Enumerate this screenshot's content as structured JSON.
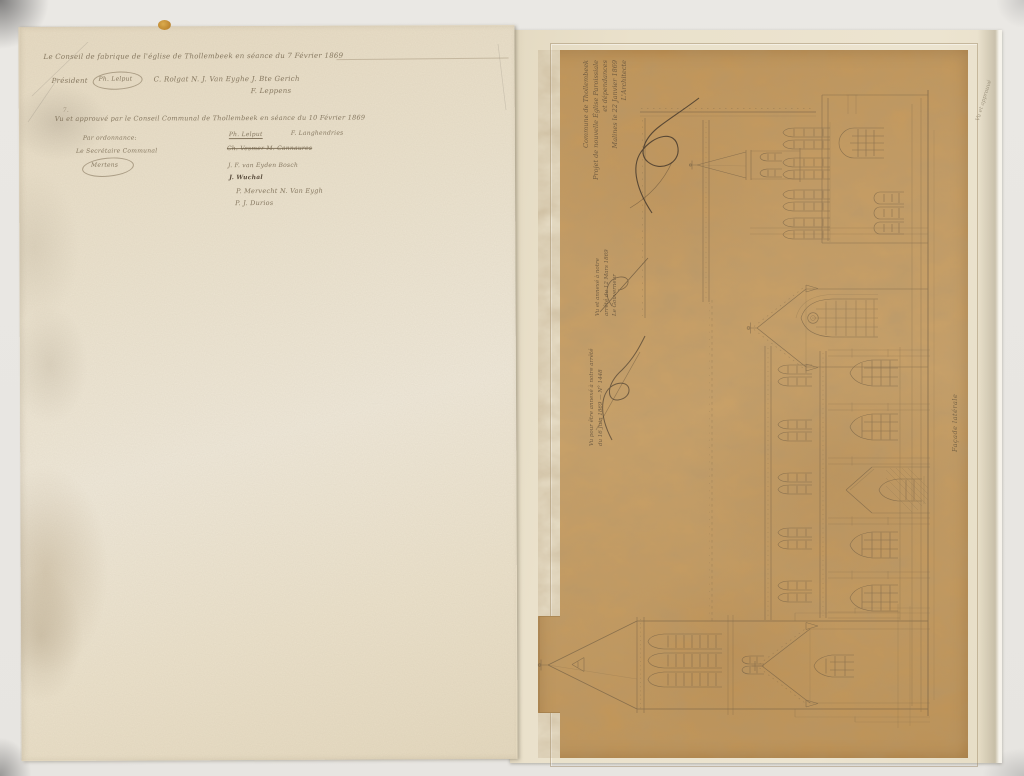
{
  "left_page": {
    "register_line": "Le Conseil de fabrique de l'église de Thollembeek en séance du 7 Février 1869",
    "president_label": "Président",
    "president_signature": "Ph. Lelput",
    "member_signatures": "C. Rolgat    N. J. Van Eyghe    J. Bte Gerich",
    "member_signature_2": "F. Leppens",
    "ordinal_mark": "7.",
    "communal_heading": "Vu et approuvé par le Conseil Communal de Thollembeek en séance du 10 Février 1869",
    "by_order": "Par ordonnance:",
    "secretary_label": "Le Secrétaire Communal",
    "secretary_signature": "Mertens",
    "council_signatures": [
      "Ph. Lelput",
      "F. Langhendries",
      "Ch. Vesmer   M. Cannaures",
      "J. F. van Eyden Bosch",
      "J. Wuchal",
      "P. Mervecht  N. Van Eygh",
      "P. J. Durios"
    ]
  },
  "sheet": {
    "title_block": {
      "lines": [
        "Commune de Thollembeek",
        "Projet de nouvelle Église Paroissiale",
        "et dépendances",
        "Malines le 22 Janvier 1869",
        "L'Architecte"
      ]
    },
    "fabric_note": {
      "lines": [
        "Vu et annexé à notre",
        "arrêté du 12 Mars 1869",
        "Le Gouverneur"
      ]
    },
    "royal_note": {
      "lines": [
        "Vu pour être annexé à notre arrêté",
        "du 16 Juin 1869 — N° 1448"
      ]
    },
    "facade_label": "Façade latérale",
    "margin_note": "Vu et approuvé"
  }
}
